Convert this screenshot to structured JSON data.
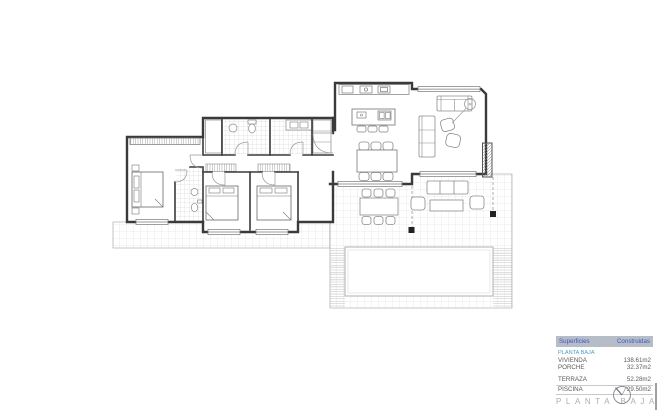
{
  "areas_table": {
    "header": {
      "surfaces_label": "Superficies",
      "built_label": "Construidas"
    },
    "group_label": "PLANTA BAJA",
    "rows": [
      {
        "label": "VIVIENDA",
        "value": "138.61m2"
      },
      {
        "label": "PORCHE",
        "value": "32.37m2"
      },
      {
        "label": "TERRAZA",
        "value": "52.28m2"
      },
      {
        "label": "PISCINA",
        "value": "29.50m2"
      }
    ],
    "colors": {
      "header_bg": "#b7bdc7",
      "header_text": "#3d55c4",
      "group_text": "#4aa0c8",
      "row_text": "#5a5a5a"
    }
  },
  "footer": {
    "title": "PLANTA BAJA",
    "icon": "north-arrow-compass-icon",
    "title_color": "#a9aeb4"
  },
  "drawing": {
    "type": "architectural-ground-floor-plan",
    "wall_color": "#3a3a3a",
    "line_color": "#8c8c8c",
    "grid_color": "#d8d8d8"
  }
}
